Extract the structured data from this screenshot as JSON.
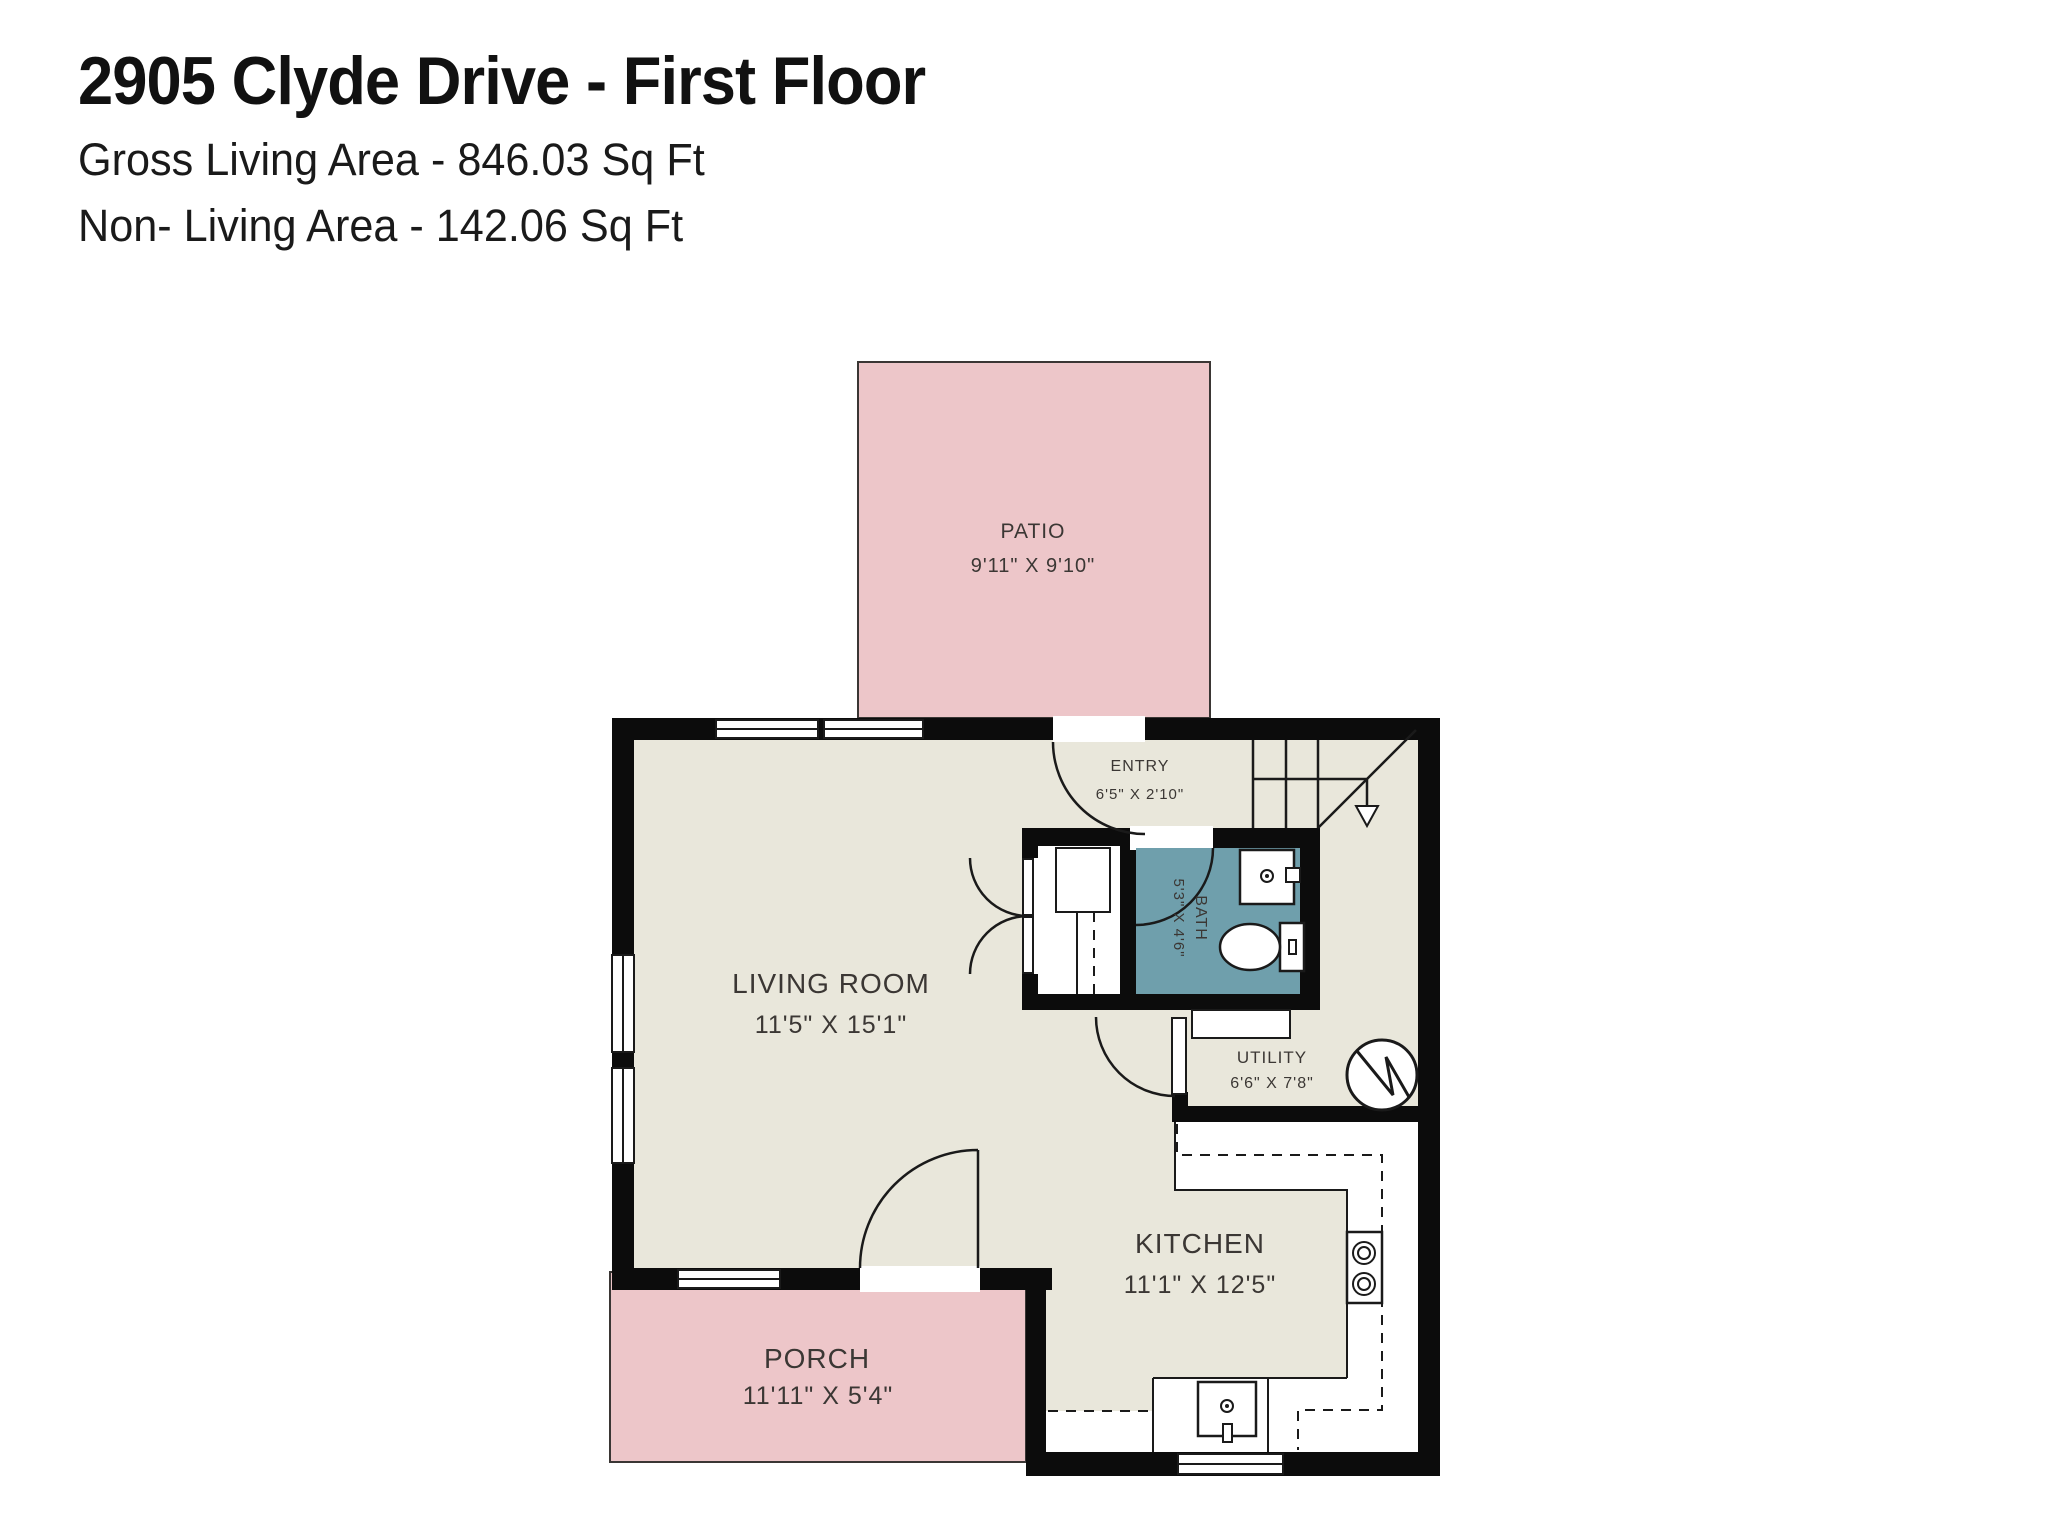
{
  "header": {
    "title": "2905 Clyde Drive - First Floor",
    "gross_living": "Gross Living Area - 846.03 Sq Ft",
    "non_living": "Non- Living Area - 142.06 Sq Ft"
  },
  "rooms": {
    "patio": {
      "name": "PATIO",
      "dims": "9'11\" X 9'10\""
    },
    "entry": {
      "name": "ENTRY",
      "dims": "6'5\" X 2'10\""
    },
    "bath": {
      "name": "BATH",
      "dims": "5'3\" X 4'6\""
    },
    "living_room": {
      "name": "LIVING ROOM",
      "dims": "11'5\" X 15'1\""
    },
    "utility": {
      "name": "UTILITY",
      "dims": "6'6\" X 7'8\""
    },
    "kitchen": {
      "name": "KITCHEN",
      "dims": "11'1\" X 12'5\""
    },
    "porch": {
      "name": "PORCH",
      "dims": "11'11\" X 5'4\""
    }
  },
  "colors": {
    "wall": "#0c0c0c",
    "floor": "#e9e7db",
    "outdoor": "#edc6c9",
    "bath": "#6f9fac",
    "fixture": "#ffffff",
    "line": "#1a1a1a",
    "outline": "#3a3634",
    "label": "#3b3734"
  }
}
